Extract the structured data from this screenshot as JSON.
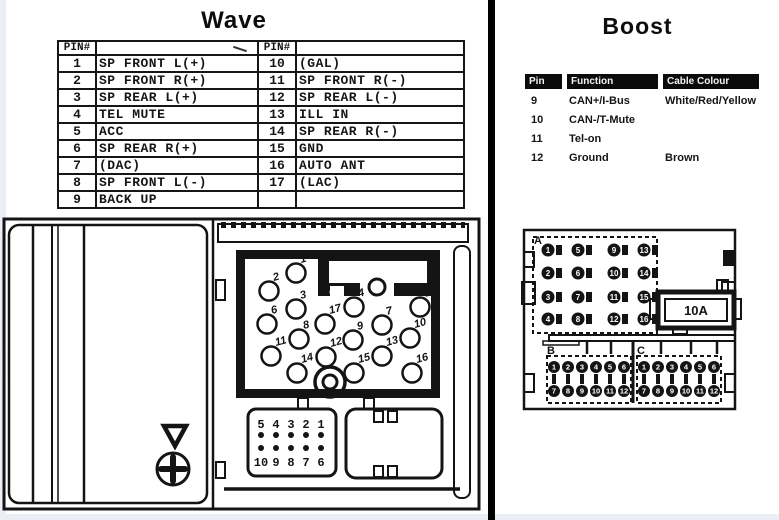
{
  "wave": {
    "title": "Wave",
    "pin_table": {
      "header_label": "PIN#",
      "rows": [
        [
          "1",
          "SP FRONT L(+)",
          "10",
          "(GAL)"
        ],
        [
          "2",
          "SP FRONT R(+)",
          "11",
          "SP FRONT R(-)"
        ],
        [
          "3",
          "SP REAR L(+)",
          "12",
          "SP REAR L(-)"
        ],
        [
          "4",
          "TEL MUTE",
          "13",
          "ILL IN"
        ],
        [
          "5",
          "ACC",
          "14",
          "SP REAR R(-)"
        ],
        [
          "6",
          "SP REAR R(+)",
          "15",
          "GND"
        ],
        [
          "7",
          "(DAC)",
          "16",
          "AUTO ANT"
        ],
        [
          "8",
          "SP FRONT L(-)",
          "17",
          "(LAC)"
        ],
        [
          "9",
          "BACK UP",
          "",
          ""
        ]
      ]
    },
    "connector": {
      "pin_labels": [
        "1",
        "2",
        "3",
        "4",
        "5",
        "6",
        "7",
        "8",
        "9",
        "10",
        "11",
        "12",
        "13",
        "14",
        "15",
        "16",
        "17"
      ],
      "harness_top_digits": [
        "5",
        "4",
        "3",
        "2",
        "1"
      ],
      "harness_bottom_digits": [
        "10",
        "9",
        "8",
        "7",
        "6"
      ]
    }
  },
  "boost": {
    "title": "Boost",
    "table": {
      "headers": [
        "Pin",
        "Function",
        "Cable Colour"
      ],
      "rows": [
        [
          "9",
          "CAN+/I-Bus",
          "White/Red/Yellow"
        ],
        [
          "10",
          "CAN-/T-Mute",
          ""
        ],
        [
          "11",
          "Tel-on",
          ""
        ],
        [
          "12",
          "Ground",
          "Brown"
        ]
      ]
    },
    "connector": {
      "section_a_label": "A",
      "section_a_pins": [
        "1",
        "2",
        "3",
        "4",
        "5",
        "6",
        "7",
        "8",
        "9",
        "10",
        "11",
        "12",
        "13",
        "14",
        "15",
        "16"
      ],
      "fuse_label": "10A",
      "section_b_label": "B",
      "section_b_pins": [
        "1",
        "2",
        "3",
        "4",
        "5",
        "6",
        "7",
        "8",
        "9",
        "10",
        "11",
        "12"
      ],
      "section_c_label": "C",
      "section_c_pins": [
        "1",
        "2",
        "3",
        "4",
        "5",
        "6",
        "7",
        "8",
        "9",
        "10",
        "11",
        "12"
      ]
    }
  },
  "colors": {
    "ink": "#141414",
    "paper": "#ffffff",
    "divider": "#000000"
  }
}
